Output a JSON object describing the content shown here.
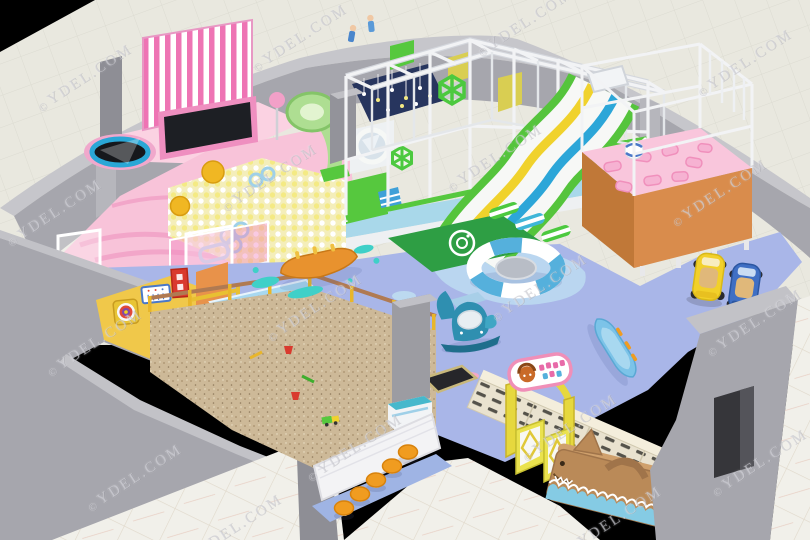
{
  "watermark": {
    "symbol": "©",
    "label": "YDEL.COM"
  },
  "palette": {
    "background_black": "#000000",
    "outer_tile": "#e9e8df",
    "marble_tile": "#f1f0ea",
    "wall_top": "#c6c6cb",
    "wall_face": "#a6a6ad",
    "wall_dark": "#8e8e95",
    "floor_blue": "#a9b6e8",
    "water_light": "#bcd9f0",
    "pink_floor": "#f8c3d9",
    "pink_wave": "#f2a6c9",
    "stripe_pink": "#ee74b4",
    "ballpit_base": "#f4eeba",
    "ball_yellow": "#f0b723",
    "trampoline_black": "#1d1f24",
    "trampoline_ring": "#2aa7d6",
    "frame_white": "#f2f3f5",
    "panel_green": "#56c83e",
    "panel_yellow": "#d9ce52",
    "ballpit_navy": "#27355e",
    "slide_green": "#55c43c",
    "slide_yellow": "#f0d22c",
    "slide_blue": "#2ca6d8",
    "mat_green": "#2e9e44",
    "platform_pink": "#f9c6dc",
    "platform_orange": "#d98c4c",
    "sand": "#cdb998",
    "fence_yellow": "#e8b62a",
    "rail_brown": "#b07a52",
    "stool_orange": "#f09c20",
    "locker_cream": "#e9e2cf",
    "gate_yellow": "#e6d83e",
    "bench_brown": "#ba8a58",
    "wave_blue": "#85cbe4",
    "car_yellow": "#f2d02a",
    "car_blue": "#3f6fc4",
    "boat_blue": "#7cc3e8",
    "whale_teal": "#2f8fb0",
    "room_yellow": "#f0c84a",
    "accent_red": "#d93a2e"
  },
  "scene": {
    "kind": "indoor children's playground 3D floor-plan render",
    "zones": [
      "toddler-ball-pit-zone",
      "striped-curtain",
      "trampolines",
      "main-play-structure",
      "triple-wave-slide",
      "landing-mat",
      "spiral-slide",
      "pink-pillow-platform",
      "blue-soft-floor",
      "banana-rocker",
      "life-ring-seat",
      "whale-rocker",
      "rocking-boat",
      "ride-on-cars",
      "sand-pit",
      "fence",
      "stools",
      "dartboard-room",
      "stairs",
      "water-channel",
      "entrance-gate",
      "shoe-lockers",
      "shark-bench",
      "rainbow-arch"
    ]
  }
}
